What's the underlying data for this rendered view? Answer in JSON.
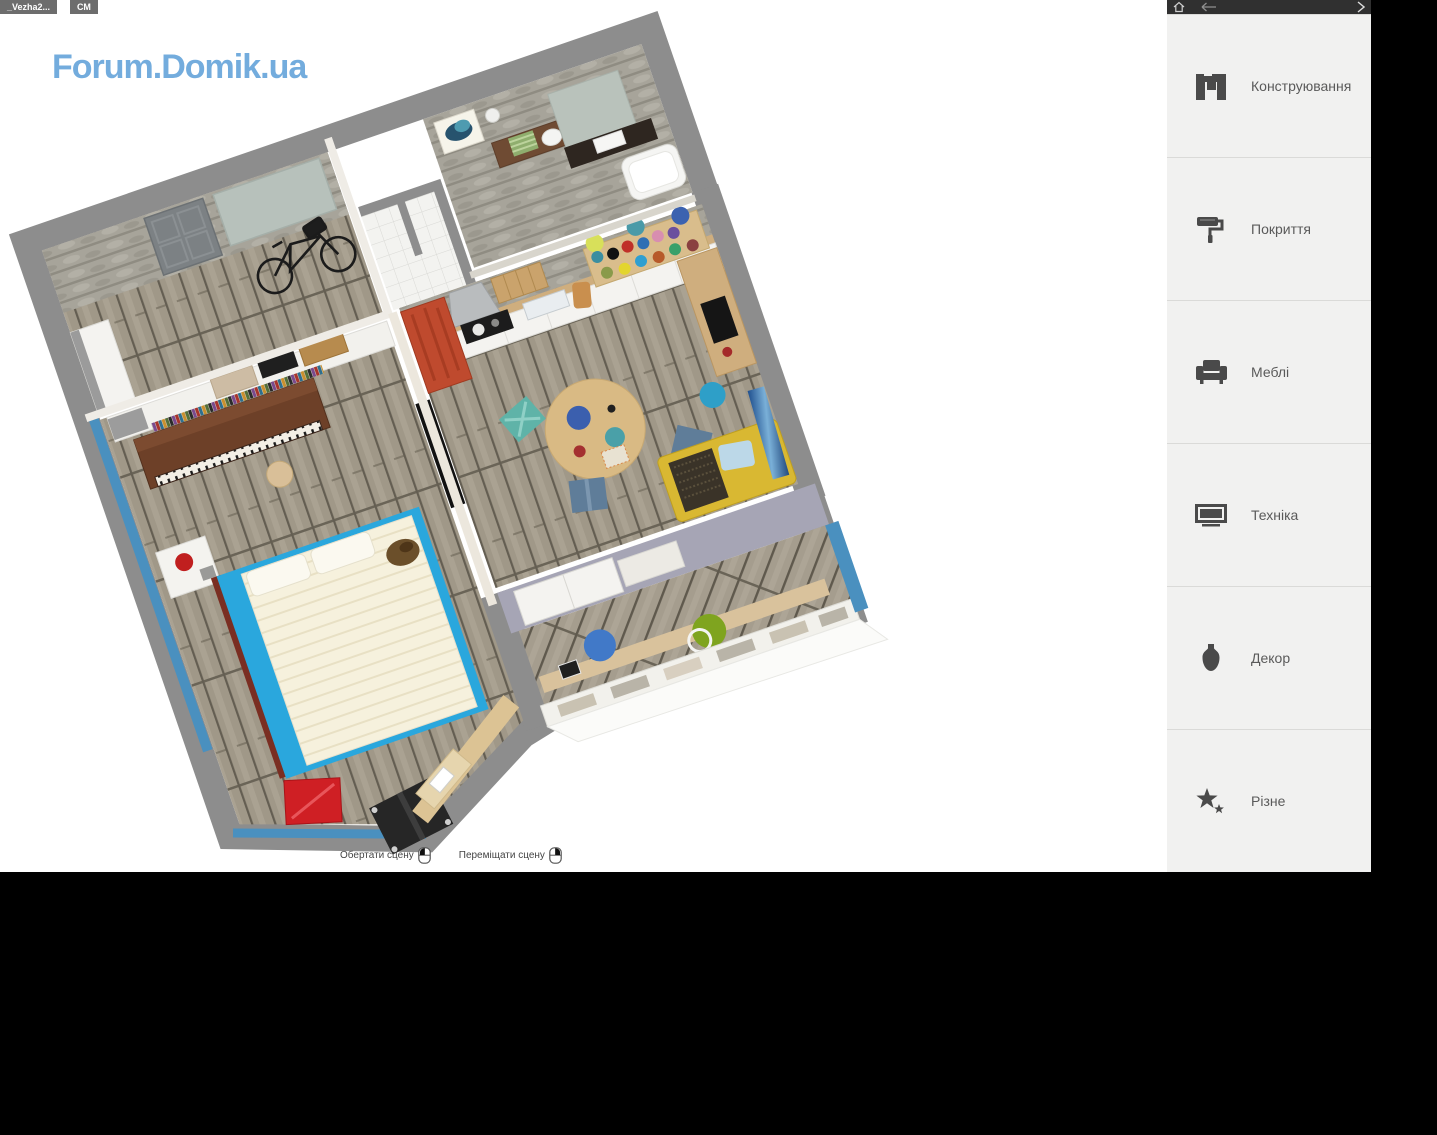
{
  "window": {
    "tabs": [
      {
        "label": "_Vezha2..."
      },
      {
        "label": "СМ"
      }
    ]
  },
  "watermark": "Forum.Domik.ua",
  "canvas": {
    "hints": [
      {
        "label": "Обертати сцену",
        "icon": "mouse-left-click-icon"
      },
      {
        "label": "Переміщати сцену",
        "icon": "mouse-right-click-icon"
      }
    ]
  },
  "sidebar": {
    "topbar": {
      "icons": [
        "home-icon",
        "back-arrow-icon",
        "forward-chevron-icon"
      ]
    },
    "items": [
      {
        "label": "Конструювання",
        "icon": "construction-plan-icon"
      },
      {
        "label": "Покриття",
        "icon": "paint-roller-icon"
      },
      {
        "label": "Меблі",
        "icon": "armchair-icon"
      },
      {
        "label": "Техніка",
        "icon": "tv-icon"
      },
      {
        "label": "Декор",
        "icon": "vase-icon"
      },
      {
        "label": "Різне",
        "icon": "stars-icon"
      }
    ]
  },
  "scene": {
    "colors": {
      "watermark_blue": "#5b9ed8",
      "outer_wall_gray": "#8d8d8d",
      "floor_wood": "#a09888",
      "stone_wall": "#a7a49a",
      "bed_blue": "#2aa7dd",
      "accent_wall_blue": "#4a90bf",
      "sofa_yellow": "#d9b832",
      "kitchen_cabinet_red": "#bf4a2e",
      "balcony_wall_lavender": "#a6a5b5",
      "sill_beige": "#d9c29c",
      "sidebar_bg": "#f1f1f0",
      "sidebar_icon_gray": "#4a4a4a",
      "topbar_dark": "#303030"
    }
  }
}
